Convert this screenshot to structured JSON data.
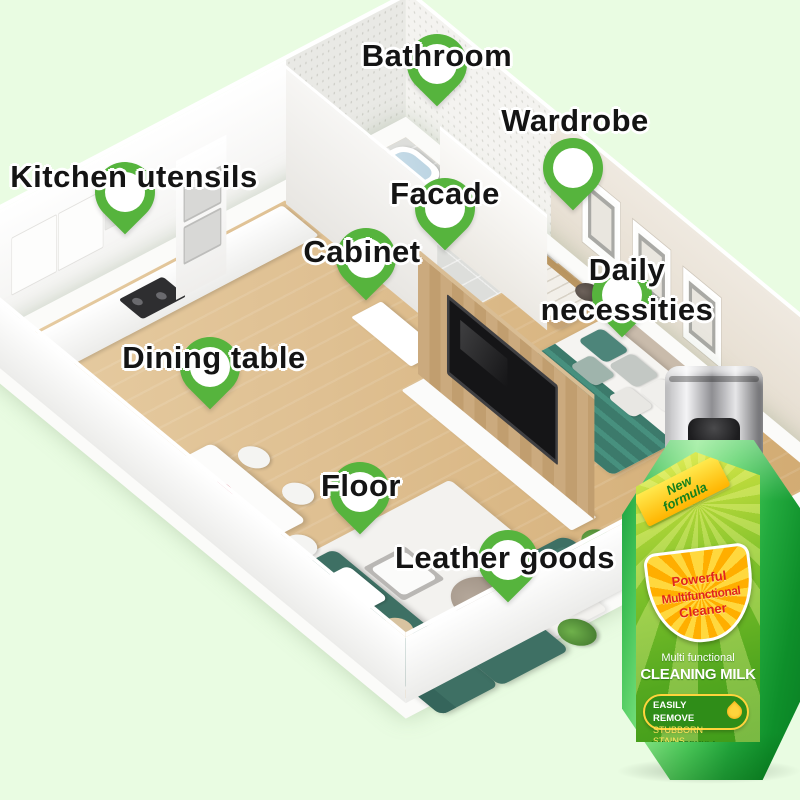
{
  "background_color": "#e9fce2",
  "pin_color": "#56b43d",
  "labels": {
    "bathroom": "Bathroom",
    "wardrobe": "Wardrobe",
    "kitchen_utensils": "Kitchen utensils",
    "facade": "Facade",
    "cabinet": "Cabinet",
    "daily_necessities": "Daily necessities",
    "dining_table": "Dining table",
    "floor": "Floor",
    "leather_goods": "Leather goods"
  },
  "bottle": {
    "ribbon": "New formula",
    "badge_lines": [
      "Powerful",
      "Multifunctional",
      "Cleaner"
    ],
    "subtitle": "Multi functional",
    "title": "CLEANING MILK",
    "highlight_line1": "EASILY REMOVE",
    "highlight_line2": "STUBBORN STAINS",
    "check": "✓",
    "features": [
      "MILD FORMULA",
      "DURABLE PROTECTION",
      "STRONG DECONTAMINATION",
      "WASH LIKE NEW"
    ],
    "weight": "300g"
  }
}
